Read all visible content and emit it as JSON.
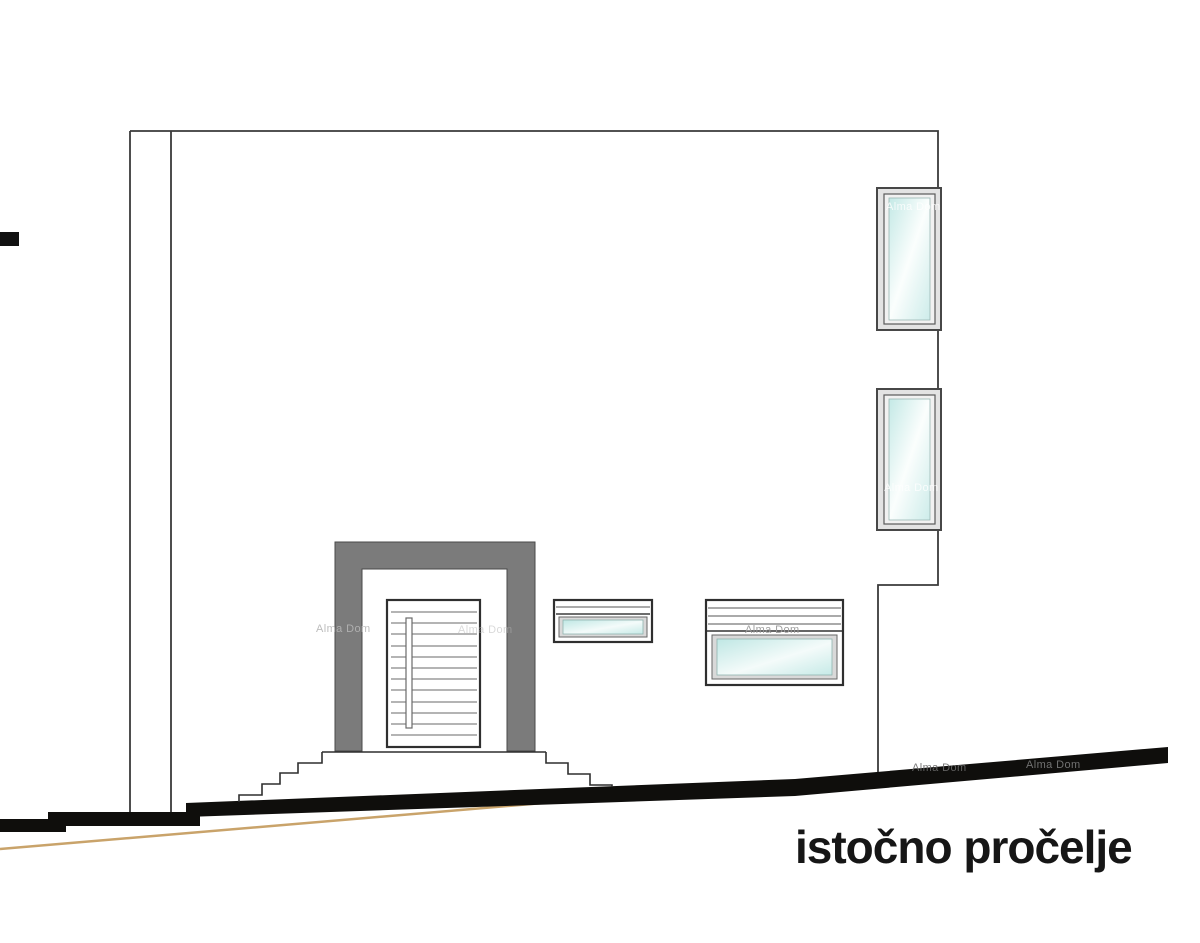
{
  "drawing": {
    "title": "istočno pročelje",
    "watermark": "Alma Dom"
  },
  "watermarks": [
    {
      "text": "Alma Dom"
    },
    {
      "text": "Alma Dom"
    },
    {
      "text": "Alma Dom"
    },
    {
      "text": "Alma Dom"
    },
    {
      "text": "Alma Dom"
    },
    {
      "text": "Alma Dom"
    },
    {
      "text": "Alma Dom"
    }
  ],
  "colors": {
    "background": "#ffffff",
    "outline": "#3a3a3a",
    "step_outline": "#2f2f2f",
    "portal_gray": "#7b7b7b",
    "ground_black": "#0f0e0c",
    "terrain_tan": "#c9a36a",
    "glass_tint": "#c9ebe8",
    "frame_gray": "#d9d9d9",
    "title_text": "#161616",
    "watermark_gray": "#b5b5b5"
  }
}
